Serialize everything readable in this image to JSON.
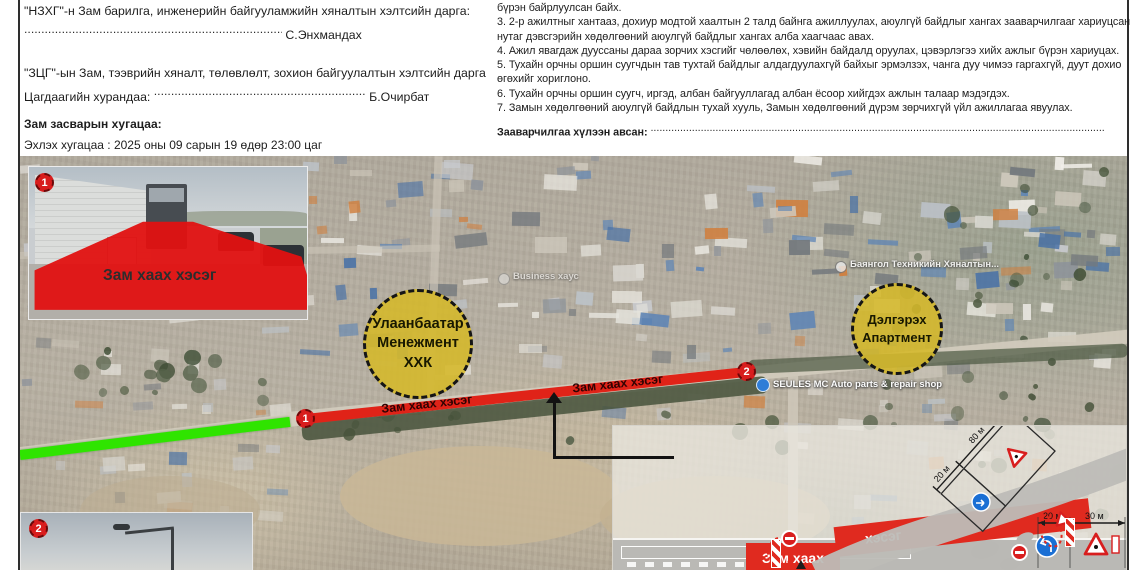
{
  "document": {
    "left_column": {
      "para1_text": "\"НЗХГ\"-н Зам барилга, инженерийн байгууламжийн хяналтын хэлтсийн дарга:",
      "para1_dots": "................................................................................................................",
      "para1_signer": "С.Энхмандах",
      "para2_text": "\"ЗЦГ\"-ын Зам, тээврийн хяналт, төлөвлөлт, зохион байгуулалтын хэлтсийн дарга Цагдаагийн хурандаа:",
      "para2_dots": "................................................................................................",
      "para2_signer": "Б.Очирбат",
      "schedule_heading": "Зам засварын хугацаа:",
      "schedule_start": "Эхлэх хугацаа : 2025 оны 09 сарын 19 өдөр 23:00 цаг",
      "schedule_end": "Дуусах хугацаа : 2025 оны 09 сарын 21 өдөр 06:00 цаг"
    },
    "right_column": {
      "lines": [
        "бүрэн байрлуулсан байх.",
        "3. 2-р ажилтныг хантааз, дохиур модтой хаалтын 2 талд байнга ажиллуулах, аюулгүй байдлыг хангах зааварчилгааг хариуцсан нутаг дэвсгэрийн хөдөлгөөний аюулгүй байдлыг хангах алба хаагчаас авах.",
        "4. Ажил явагдаж дууссаны дараа зорчих хэсгийг чөлөөлөх, хэвийн байдалд оруулах, цэвэрлэгээ хийх ажлыг бүрэн хариуцах.",
        "5. Тухайн орчны оршин суугчдын тав тухтай байдлыг алдагдуулахгүй байхыг эрмэлзэх, чанга дуу чимээ гаргахгүй, дуут дохио өгөхийг хориглоно.",
        "6. Тухайн орчны оршин суугч, иргэд, албан байгууллагад албан ёсоор хийгдэх ажлын талаар мэдэгдэх.",
        "7. Замын хөдөлгөөний аюулгүй байдлын тухай хууль, Замын хөдөлгөөний дүрэм зөрчихгүй үйл ажиллагаа явуулах."
      ],
      "receipt_label": "Зааварчилгаа хүлээн авсан:",
      "receipt_dots": "........................................................................................................................................................................................"
    }
  },
  "map": {
    "badge1": "1",
    "badge2": "2",
    "inset1_caption": "Зам хаах хэсэг",
    "closure_label": "Зам хаах хэсэг",
    "zone1": {
      "line1": "Улаанбаатар",
      "line2": "Менежмент",
      "line3": "ХХК"
    },
    "zone2": {
      "line1": "Дэлгэрэх",
      "line2": "Апартмент"
    },
    "poi_bayangol": "Баянгол Техникийн Хяналтын...",
    "poi_seules": "SEULES MC Auto parts & repair shop",
    "poi_business": "Business хаус",
    "diagram": {
      "closure_a": "Зам хаах",
      "closure_b": "хэсэг",
      "dim_20a": "20 м",
      "dim_80": "80 м",
      "dim_20b": "20 м",
      "dim_30": "30 м"
    }
  },
  "colors": {
    "closure_red": "#e02318",
    "open_green": "#2fe400",
    "zone_yellow": "#d5b829",
    "badge_red": "#d81d1d"
  }
}
